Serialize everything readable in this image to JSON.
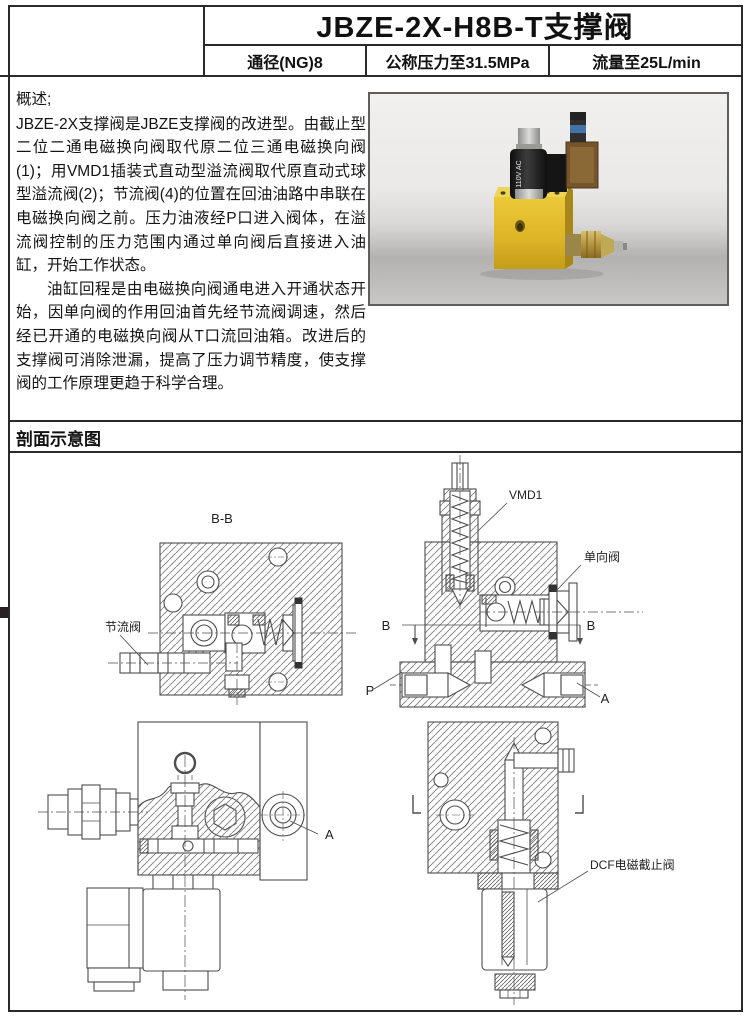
{
  "header": {
    "title": "JBZE-2X-H8B-T支撑阀",
    "specs": [
      "通径(NG)8",
      "公称压力至31.5MPa",
      "流量至25L/min"
    ]
  },
  "overview": {
    "heading": "概述;",
    "paragraph1": "JBZE-2X支撑阀是JBZE支撑阀的改进型。由截止型二位二通电磁换向阀取代原二位三通电磁换向阀(1)；用VMD1插装式直动型溢流阀取代原直动式球型溢流阀(2)；节流阀(4)的位置在回油油路中串联在电磁换向阀之前。压力油液经P口进入阀体，在溢流阀控制的压力范围内通过单向阀后直接进入油缸，开始工作状态。",
    "paragraph2": "油缸回程是由电磁换向阀通电进入开通状态开始，因单向阀的作用回油首先经节流阀调速，然后经已开通的电磁换向阀从T口流回油箱。改进后的支撑阀可消除泄漏，提高了压力调节精度，使支撑阀的工作原理更趋于科学合理。"
  },
  "photo": {
    "coil_voltage_label": "110V AC",
    "colors": {
      "valve_block_yellow": "#ddb529",
      "coil_black": "#1e1e1e",
      "connector_brown": "#7a5526",
      "background_top": "#f1f0ee",
      "background_bottom": "#c8c7c5"
    }
  },
  "diagram": {
    "heading": "剖面示意图",
    "view_bb_title": "B-B",
    "throttle_valve": "节流阀",
    "vmd1": "VMD1",
    "check_valve": "单向阀",
    "section_mark_left": "B",
    "section_mark_right": "B",
    "port_p": "P",
    "port_a": "A",
    "side_view_port_a": "A",
    "dcf_valve": "DCF电磁截止阀"
  },
  "page_colors": {
    "border": "#2a2a2a",
    "drawing_line": "#4d4d4d"
  }
}
